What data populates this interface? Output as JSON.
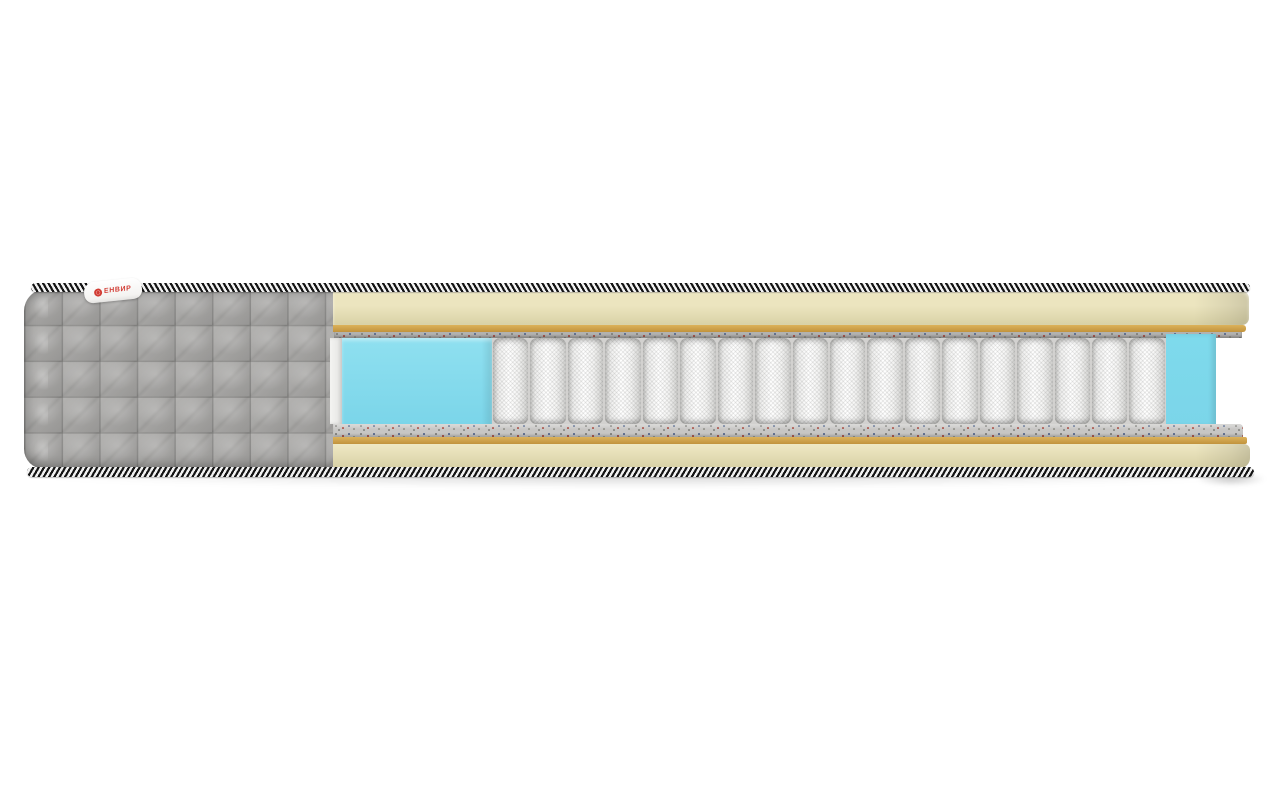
{
  "scene": {
    "description": "3D cutaway render of a pocket-spring mattress cross-section on white background",
    "background": "#ffffff"
  },
  "tag": {
    "text": "ЕНВИР",
    "logo_icon": "brand-ring-icon",
    "text_color": "#d23b33"
  },
  "springs": {
    "count": 18
  },
  "layers": [
    {
      "id": "braid-top",
      "desc": "striped braided edge cord (top)",
      "colors": [
        "#141414",
        "#f2f2f2"
      ]
    },
    {
      "id": "foam-top",
      "desc": "cream comfort foam layer (top)",
      "color": "#e9e2bb"
    },
    {
      "id": "gold-top",
      "desc": "tan latexed-coir layer (top)",
      "color": "#d7ab52"
    },
    {
      "id": "felt-top",
      "desc": "speckled felt pad (top)",
      "color": "#b3b2b0"
    },
    {
      "id": "edge-foam-left",
      "desc": "blue foam edge support block (left)",
      "color": "#85dbed"
    },
    {
      "id": "pocket-springs",
      "desc": "white fabric-wrapped independent springs",
      "color": "#f5f5f4"
    },
    {
      "id": "edge-foam-right",
      "desc": "blue foam wall (right)",
      "color": "#7edaec"
    },
    {
      "id": "felt-bottom",
      "desc": "speckled felt pad (bottom)",
      "color": "#c7c6c4"
    },
    {
      "id": "gold-bottom",
      "desc": "tan latexed-coir layer (bottom)",
      "color": "#d7ab52"
    },
    {
      "id": "foam-bottom",
      "desc": "cream comfort foam layer (bottom)",
      "color": "#eee8c2"
    },
    {
      "id": "braid-bottom",
      "desc": "striped braided edge cord (bottom)",
      "colors": [
        "#141414",
        "#f2f2f2"
      ]
    },
    {
      "id": "quilt-cover",
      "desc": "grey quilted cover with square tufting (left end)",
      "color": "#a8a7a5"
    }
  ],
  "colors": {
    "quilt": "#a8a7a5",
    "cream1": "#ece5bf",
    "cream2": "#d8d1a6",
    "cream3": "#efe9c4",
    "gold1": "#dcb25a",
    "gold2": "#c1933d",
    "felt": "#b3b2b0",
    "feltB": "#c7c6c4",
    "blue1": "#8fe0f0",
    "blue2": "#7bd5e9",
    "blueR": "#7edaec",
    "braidDark": "#141414",
    "braidLight": "#f2f2f2",
    "tagRed": "#d23b33"
  }
}
